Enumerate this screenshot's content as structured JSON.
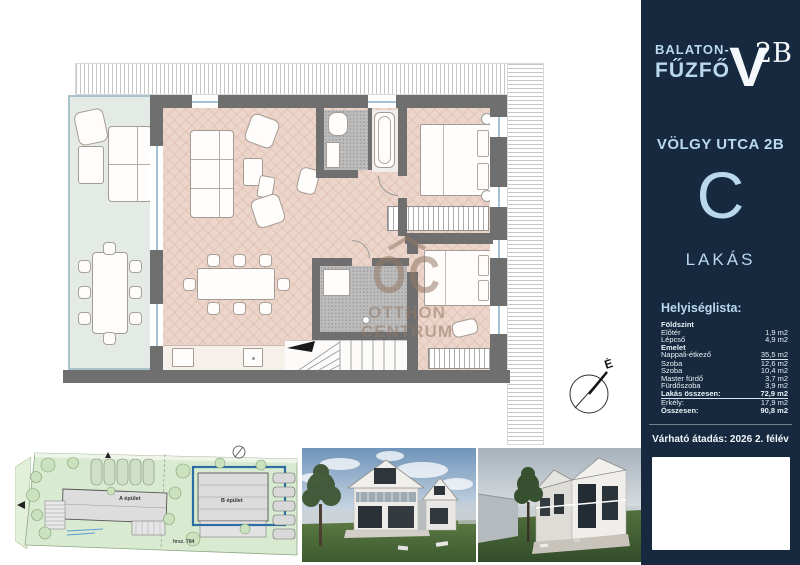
{
  "sidebar": {
    "location_line1": "BALATON-",
    "location_line2": "FŰZFŐ",
    "logo_v": "V",
    "logo_sup": "2B",
    "address": "VÖLGY UTCA 2B",
    "unit_letter": "C",
    "unit_label": "LAKÁS",
    "list_title": "Helyiséglista:",
    "rooms": [
      {
        "label": "Földszint",
        "value": ""
      },
      {
        "label": "Előtér",
        "value": "1,9 m2"
      },
      {
        "label": "Lépcső",
        "value": "4,9 m2"
      },
      {
        "label": "Emelet",
        "value": ""
      },
      {
        "label": "Nappali-étkező",
        "value": "35,5 m2"
      },
      {
        "label": "Szoba",
        "value": "12,6 m2"
      },
      {
        "label": "Szoba",
        "value": "10,4 m2"
      },
      {
        "label": "Master fürdő",
        "value": "3,7 m2"
      },
      {
        "label": "Fürdőszoba",
        "value": "3,9 m2"
      },
      {
        "label": "Lakás összesen:",
        "value": "72,9 m2"
      },
      {
        "label": "Erkély:",
        "value": "17,9 m2"
      },
      {
        "label": "Összesen:",
        "value": "90,8 m2"
      }
    ],
    "delivery": "Várható átadás: 2026 2. félév",
    "colors": {
      "bg": "#16293e",
      "accent": "#b9d8ee",
      "text": "#e9f1f8"
    }
  },
  "floorplan": {
    "compass_label": "É",
    "watermark_logo": "OC",
    "watermark_line1": "OTTHON",
    "watermark_line2": "CENTRUM"
  },
  "siteplan": {
    "building_a_label": "A épület",
    "building_b_label": "B épület",
    "parcel_label": "hrsz. 784",
    "highlight_color": "#2e6da4"
  }
}
